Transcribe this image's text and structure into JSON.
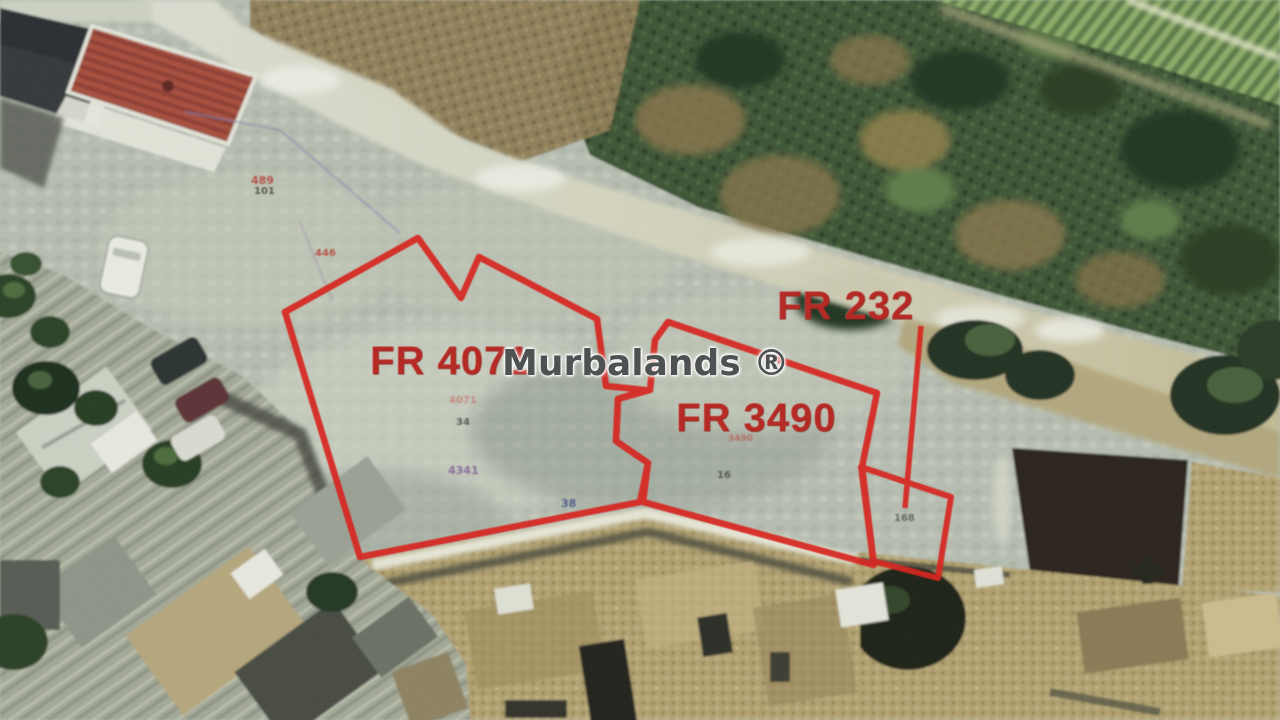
{
  "watermark": {
    "text": "Murbalands ®"
  },
  "parcels": {
    "fr4071": {
      "label": "FR 4071"
    },
    "fr3490": {
      "label": "FR 3490"
    },
    "fr232": {
      "label": "FR 232"
    }
  },
  "ground_marks": {
    "m1": "489",
    "m2": "101",
    "m3": "446",
    "m4": "4071",
    "m5": "34",
    "m6": "4341",
    "m7": "38",
    "m8": "3490",
    "m9": "16",
    "m10": "168"
  },
  "colors": {
    "parcel_outline": "#d8231c",
    "parcel_label": "#b52a24",
    "watermark_gray": "#4e5252"
  }
}
